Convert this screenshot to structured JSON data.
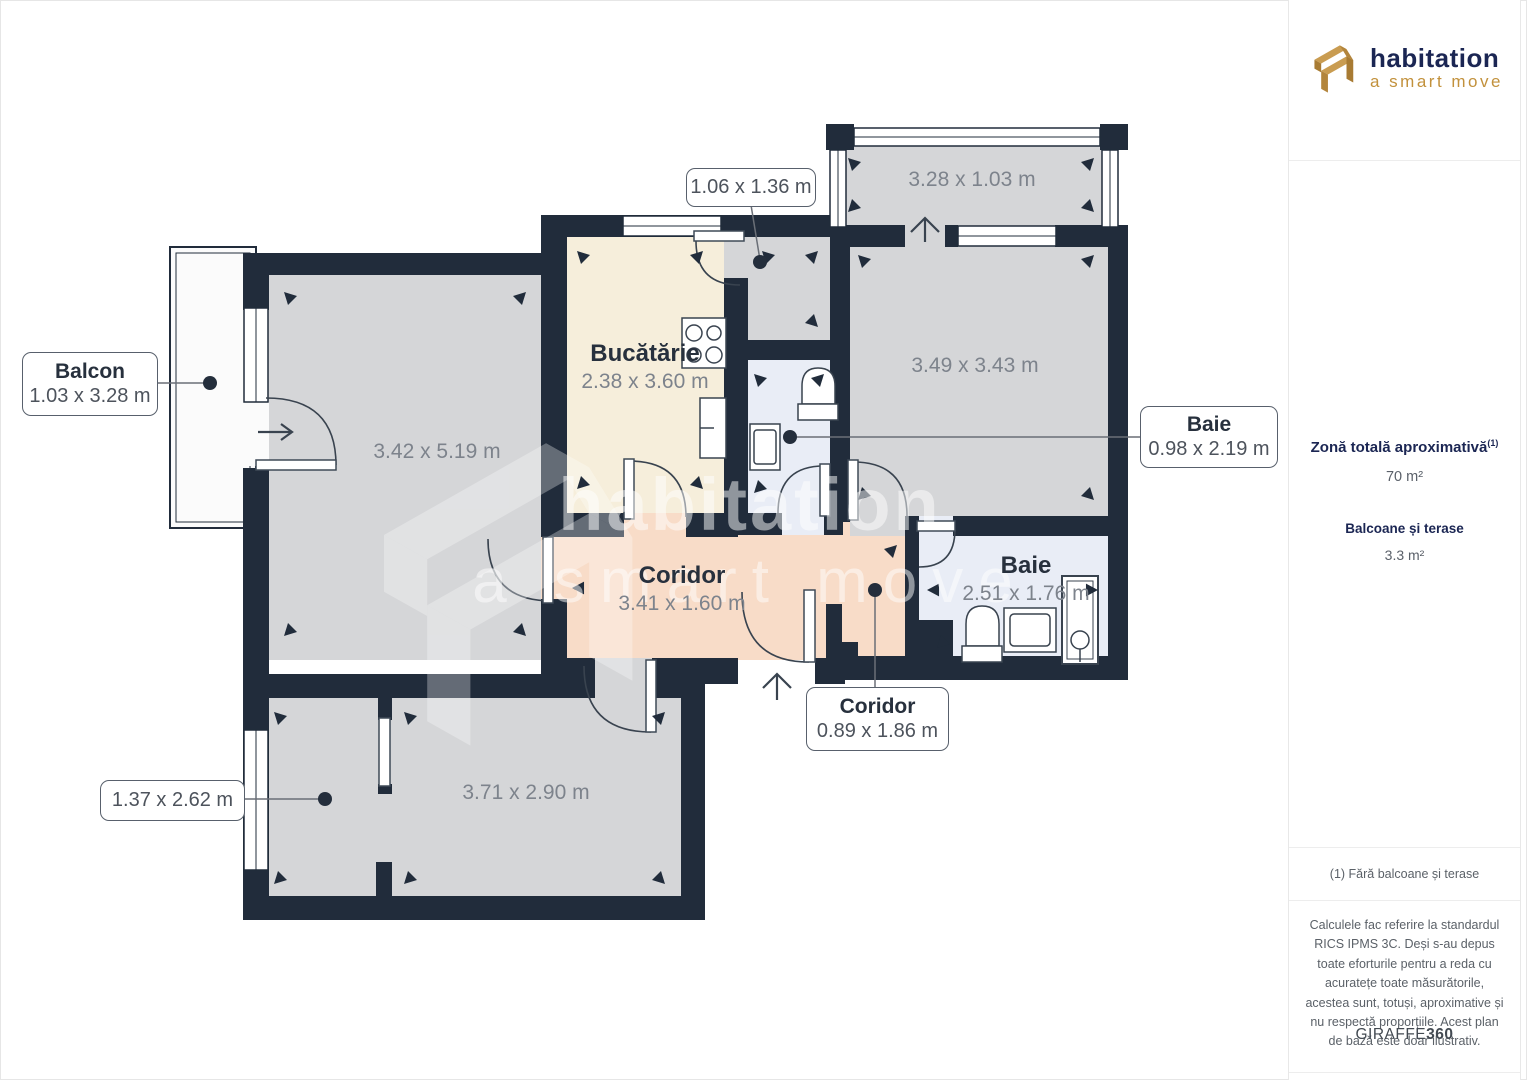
{
  "brand": {
    "name": "habitation",
    "tagline": "a smart move"
  },
  "sidebar": {
    "area_title": "Zonă totală aproximativă",
    "area_title_sup": "(1)",
    "area_value": "70 m²",
    "balcony_title": "Balcoane și terase",
    "balcony_value": "3.3 m²",
    "footnote": "(1) Fără balcoane și terase",
    "disclaimer": "Calculele fac referire la standardul RICS IPMS 3C. Deși s-au depus toate eforturile pentru a reda cu acuratețe toate măsurătorile, acestea sunt, totuși, aproximative și nu respectă proporțiile. Acest plan de bază este doar ilustrativ.",
    "provider_name": "GIRAFFE",
    "provider_suffix": "360"
  },
  "floorplan": {
    "watermark_line1": "habitation",
    "watermark_line2": "a smart move",
    "rooms": [
      {
        "name": "",
        "dims": "3.42 x 5.19 m"
      },
      {
        "name": "Bucătărie",
        "dims": "2.38 x 3.60 m"
      },
      {
        "name": "",
        "dims": "3.28 x 1.03 m"
      },
      {
        "name": "",
        "dims": "3.49 x 3.43 m"
      },
      {
        "name": "Baie",
        "dims": "2.51 x 1.76 m"
      },
      {
        "name": "Coridor",
        "dims": "3.41 x 1.60 m"
      },
      {
        "name": "",
        "dims": "3.71 x 2.90 m"
      }
    ],
    "callouts": [
      {
        "title": "Balcon",
        "dims": "1.03 x 3.28 m"
      },
      {
        "title": "",
        "dims": "1.06 x 1.36 m"
      },
      {
        "title": "Baie",
        "dims": "0.98 x 2.19 m"
      },
      {
        "title": "Coridor",
        "dims": "0.89 x 1.86 m"
      },
      {
        "title": "",
        "dims": "1.37 x 2.62 m"
      }
    ]
  },
  "colors": {
    "wall": "#212C3B",
    "room_gray": "#D5D6D8",
    "kitchen": "#F6EEDB",
    "corridor": "#F8DCC8",
    "bath": "#E9EDF6",
    "balcony": "#FBFBFB",
    "navy": "#1B2653",
    "gold": "#C2913C"
  }
}
